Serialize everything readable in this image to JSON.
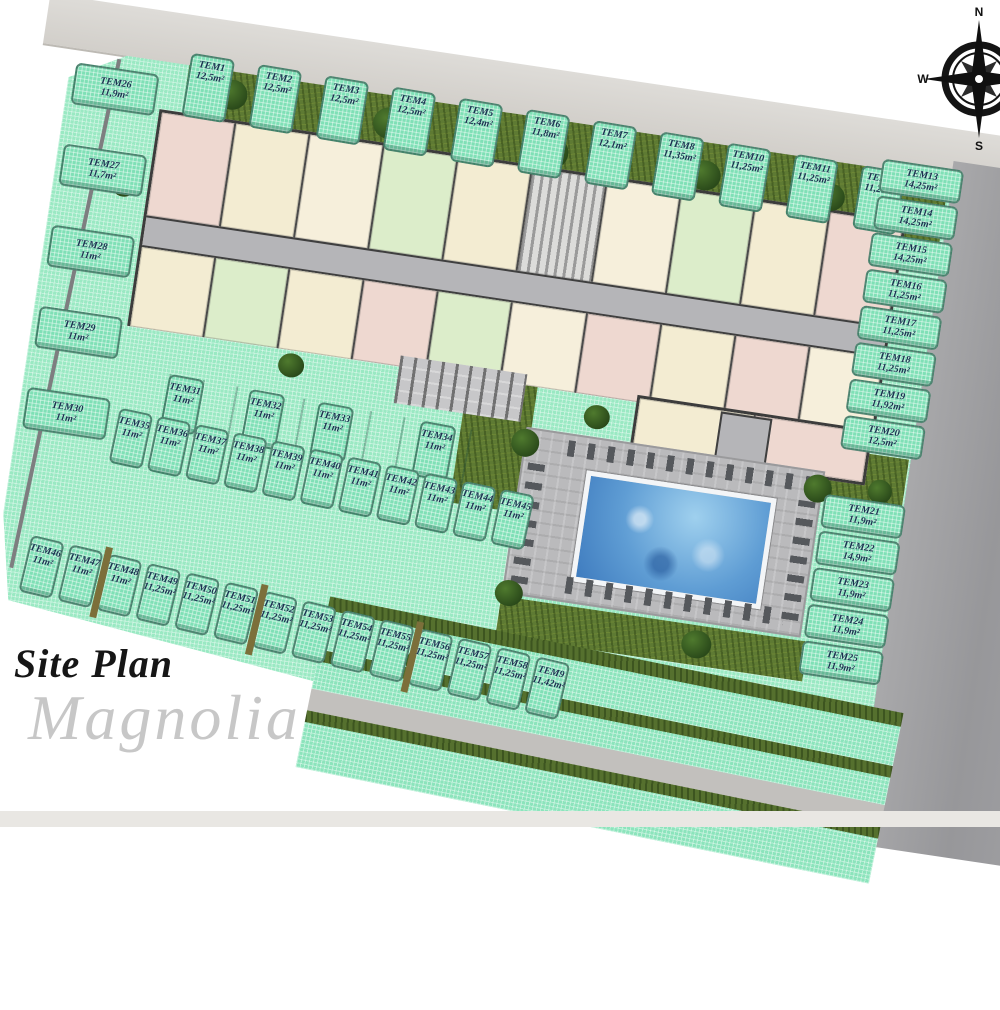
{
  "title": {
    "line1": "Site Plan",
    "line2": "Magnolia"
  },
  "compass": {
    "n": "N",
    "w": "W",
    "s": "S",
    "e": "E"
  },
  "colors": {
    "lawn_mint": "#8ce4bc",
    "spot_teal": "#7fe0b6",
    "rough_grass": "#5e7a33",
    "road_light": "#d7d5d1",
    "road_dark": "#9c9c9e",
    "pool_blue": "#5f9dd4",
    "wall_dark": "#3c3c3c",
    "room_cream": "#f3ecd2",
    "room_green": "#dcedca",
    "room_pink": "#eed8d0",
    "label_text": "#1b3050"
  },
  "parking": {
    "row_top": [
      {
        "label": "TEM1",
        "area": "12,5m²"
      },
      {
        "label": "TEM2",
        "area": "12,5m²"
      },
      {
        "label": "TEM3",
        "area": "12,5m²"
      },
      {
        "label": "TEM4",
        "area": "12,5m²"
      },
      {
        "label": "TEM5",
        "area": "12,4m²"
      },
      {
        "label": "TEM6",
        "area": "11,8m²"
      },
      {
        "label": "TEM7",
        "area": "12,1m²"
      },
      {
        "label": "TEM8",
        "area": "11,35m²"
      },
      {
        "label": "TEM10",
        "area": "11,25m²"
      },
      {
        "label": "TEM11",
        "area": "11,25m²"
      },
      {
        "label": "TEM12",
        "area": "11,25m²"
      }
    ],
    "col_right": [
      {
        "label": "TEM13",
        "area": "14,25m²"
      },
      {
        "label": "TEM14",
        "area": "14,25m²"
      },
      {
        "label": "TEM15",
        "area": "14,25m²"
      },
      {
        "label": "TEM16",
        "area": "11,25m²"
      },
      {
        "label": "TEM17",
        "area": "11,25m²"
      },
      {
        "label": "TEM18",
        "area": "11,25m²"
      },
      {
        "label": "TEM19",
        "area": "11,92m²"
      },
      {
        "label": "TEM20",
        "area": "12,5m²"
      }
    ],
    "col_right_lower": [
      {
        "label": "TEM21",
        "area": "11,9m²"
      },
      {
        "label": "TEM22",
        "area": "14,9m²"
      },
      {
        "label": "TEM23",
        "area": "11,9m²"
      },
      {
        "label": "TEM24",
        "area": "11,9m²"
      },
      {
        "label": "TEM25",
        "area": "11,9m²"
      }
    ],
    "col_left": [
      {
        "label": "TEM26",
        "area": "11,9m²"
      },
      {
        "label": "TEM27",
        "area": "11,7m²"
      },
      {
        "label": "TEM28",
        "area": "11m²"
      },
      {
        "label": "TEM29",
        "area": "11m²"
      },
      {
        "label": "TEM30",
        "area": "11m²"
      }
    ],
    "row_mid_upper": [
      {
        "label": "TEM31",
        "area": "11m²"
      },
      {
        "label": "TEM32",
        "area": "11m²"
      },
      {
        "label": "TEM33",
        "area": "11m²"
      },
      {
        "label": "TEM34",
        "area": "11m²"
      }
    ],
    "row_mid_lower": [
      {
        "label": "TEM35",
        "area": "11m²"
      },
      {
        "label": "TEM36",
        "area": "11m²"
      },
      {
        "label": "TEM37",
        "area": "11m²"
      },
      {
        "label": "TEM38",
        "area": "11m²"
      },
      {
        "label": "TEM39",
        "area": "11m²"
      },
      {
        "label": "TEM40",
        "area": "11m²"
      },
      {
        "label": "TEM41",
        "area": "11m²"
      },
      {
        "label": "TEM42",
        "area": "11m²"
      },
      {
        "label": "TEM43",
        "area": "11m²"
      },
      {
        "label": "TEM44",
        "area": "11m²"
      },
      {
        "label": "TEM45",
        "area": "11m²"
      }
    ],
    "row_bottom": [
      {
        "label": "TEM46",
        "area": "11m²"
      },
      {
        "label": "TEM47",
        "area": "11m²"
      },
      {
        "label": "TEM48",
        "area": "11m²"
      },
      {
        "label": "TEM49",
        "area": "11,25m²"
      },
      {
        "label": "TEM50",
        "area": "11,25m²"
      },
      {
        "label": "TEM51",
        "area": "11,25m²"
      },
      {
        "label": "TEM52",
        "area": "11,25m²"
      },
      {
        "label": "TEM53",
        "area": "11,25m²"
      },
      {
        "label": "TEM54",
        "area": "11,25m²"
      },
      {
        "label": "TEM55",
        "area": "11,25m²"
      },
      {
        "label": "TEM56",
        "area": "11,25m²"
      },
      {
        "label": "TEM57",
        "area": "11,25m²"
      },
      {
        "label": "TEM58",
        "area": "11,25m²"
      },
      {
        "label": "TEM9",
        "area": "11,42m²"
      }
    ]
  }
}
